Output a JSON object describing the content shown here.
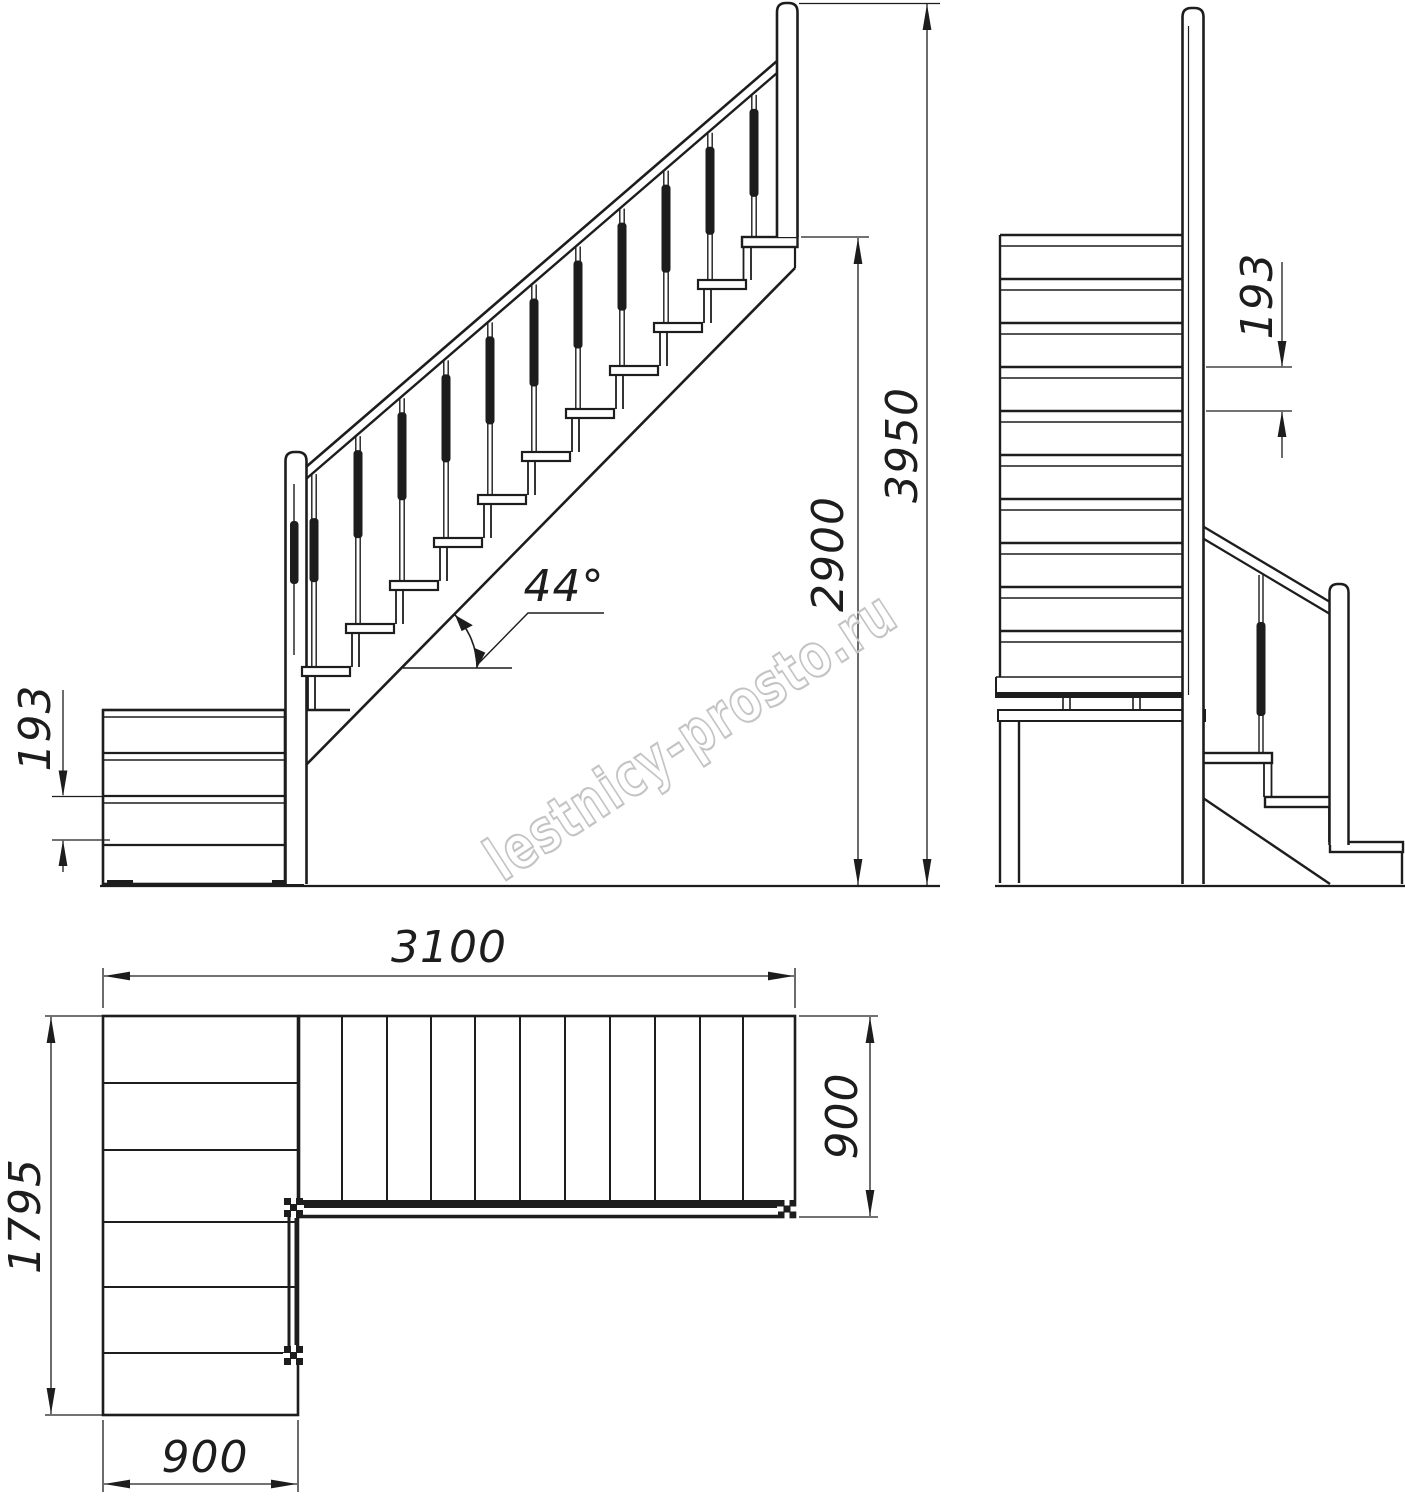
{
  "watermark": {
    "text": "lestnicy-prosto.ru",
    "color": "#c4c4c4"
  },
  "style": {
    "line_color": "#1d1d1d",
    "background": "#ffffff"
  },
  "views": {
    "side_elevation": {
      "title": "side elevation of L-shaped staircase",
      "dimensions": {
        "riser_height": {
          "label": "193"
        },
        "slope_angle": {
          "label": "44°"
        },
        "floor_to_landing_height": {
          "label": "2900"
        },
        "total_height": {
          "label": "3950"
        }
      }
    },
    "front_elevation": {
      "title": "front elevation of main flight",
      "dimensions": {
        "riser_height": {
          "label": "193"
        }
      }
    },
    "plan": {
      "title": "plan view of L-shaped staircase",
      "dimensions": {
        "total_length": {
          "label": "3100"
        },
        "total_width": {
          "label": "1795"
        },
        "lower_flight_width": {
          "label": "900"
        },
        "main_flight_width": {
          "label": "900"
        }
      }
    }
  }
}
